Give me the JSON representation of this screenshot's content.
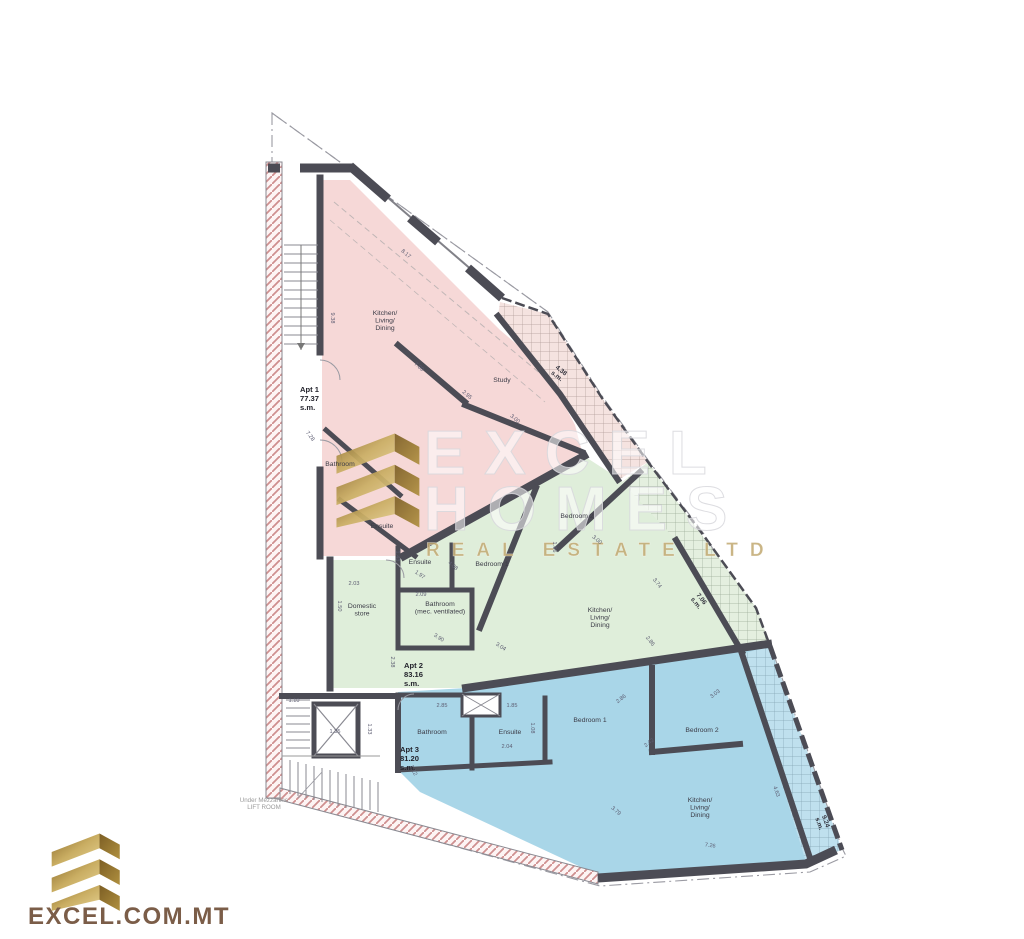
{
  "watermark": {
    "title": "EXCEL",
    "subtitle": "HOMES",
    "tagline": "REAL ESTATE LTD"
  },
  "brand": {
    "name": "EXCEL.COM.MT",
    "gold_dark": "#8a6a2a",
    "gold_light": "#e6d293",
    "text_color": "#7b5d48"
  },
  "plan": {
    "apartments": [
      {
        "name": "Apt 1",
        "area": "77.37",
        "unit": "s.m.",
        "color": "#f6d8d7"
      },
      {
        "name": "Apt 2",
        "area": "83.16",
        "unit": "s.m.",
        "color": "#dfeeda"
      },
      {
        "name": "Apt 3",
        "area": "81.20",
        "unit": "s.m.",
        "color": "#a9d6e8"
      }
    ],
    "apt_labels": [
      {
        "lines": [
          "Apt 1",
          "77.37",
          "s.m."
        ],
        "x": 300,
        "y": 392
      },
      {
        "lines": [
          "Apt 2",
          "83.16",
          "s.m."
        ],
        "x": 404,
        "y": 668
      },
      {
        "lines": [
          "Apt 3",
          "81.20",
          "s.m."
        ],
        "x": 400,
        "y": 752
      }
    ],
    "room_labels": [
      {
        "lines": [
          "Kitchen/",
          "Living/",
          "Dining"
        ],
        "x": 385,
        "y": 315
      },
      {
        "lines": [
          "Study"
        ],
        "x": 502,
        "y": 382
      },
      {
        "lines": [
          "Bathroom"
        ],
        "x": 340,
        "y": 466
      },
      {
        "lines": [
          "Ensuite"
        ],
        "x": 382,
        "y": 528
      },
      {
        "lines": [
          "Ensuite"
        ],
        "x": 420,
        "y": 564
      },
      {
        "lines": [
          "Bedroom 1"
        ],
        "x": 492,
        "y": 566
      },
      {
        "lines": [
          "Bedroom 2"
        ],
        "x": 577,
        "y": 518
      },
      {
        "lines": [
          "Domestic",
          "store"
        ],
        "x": 362,
        "y": 608
      },
      {
        "lines": [
          "Bathroom",
          "(mec. ventilated)"
        ],
        "x": 440,
        "y": 606
      },
      {
        "lines": [
          "Kitchen/",
          "Living/",
          "Dining"
        ],
        "x": 600,
        "y": 612
      },
      {
        "lines": [
          "Bathroom"
        ],
        "x": 432,
        "y": 734
      },
      {
        "lines": [
          "Ensuite"
        ],
        "x": 510,
        "y": 734
      },
      {
        "lines": [
          "Bedroom 1"
        ],
        "x": 590,
        "y": 722
      },
      {
        "lines": [
          "Bedroom 2"
        ],
        "x": 702,
        "y": 732
      },
      {
        "lines": [
          "Kitchen/",
          "Living/",
          "Dining"
        ],
        "x": 700,
        "y": 802
      }
    ],
    "terrace_labels": [
      {
        "lines": [
          "4.38",
          "s.m."
        ],
        "x": 560,
        "y": 372,
        "r": 38
      },
      {
        "lines": [
          "7.06",
          "s.m."
        ],
        "x": 700,
        "y": 600,
        "r": 52
      },
      {
        "lines": [
          "9.24",
          "s.m."
        ],
        "x": 824,
        "y": 822,
        "r": 70
      }
    ],
    "dimensions": [
      {
        "t": "8.17",
        "x": 405,
        "y": 255,
        "r": 40
      },
      {
        "t": "9.38",
        "x": 331,
        "y": 318,
        "r": 90
      },
      {
        "t": "7.89",
        "x": 418,
        "y": 368,
        "r": 40
      },
      {
        "t": "7.28",
        "x": 309,
        "y": 437,
        "r": 52
      },
      {
        "t": "2.95",
        "x": 466,
        "y": 396,
        "r": 40
      },
      {
        "t": "3.00",
        "x": 514,
        "y": 420,
        "r": 40
      },
      {
        "t": "1.43",
        "x": 396,
        "y": 556,
        "r": 90
      },
      {
        "t": "1.97",
        "x": 419,
        "y": 576,
        "r": 35
      },
      {
        "t": "4.08",
        "x": 452,
        "y": 567,
        "r": 40
      },
      {
        "t": "2.03",
        "x": 354,
        "y": 585,
        "r": 0
      },
      {
        "t": "2.09",
        "x": 421,
        "y": 596,
        "r": 0
      },
      {
        "t": "1.50",
        "x": 338,
        "y": 606,
        "r": 90
      },
      {
        "t": "3.90",
        "x": 438,
        "y": 639,
        "r": 33
      },
      {
        "t": "3.04",
        "x": 500,
        "y": 648,
        "r": 33
      },
      {
        "t": "2.38",
        "x": 391,
        "y": 662,
        "r": 90
      },
      {
        "t": "3.00",
        "x": 596,
        "y": 541,
        "r": 40
      },
      {
        "t": "1.66",
        "x": 553,
        "y": 547,
        "r": 90
      },
      {
        "t": "3.74",
        "x": 656,
        "y": 584,
        "r": 52
      },
      {
        "t": "2.86",
        "x": 649,
        "y": 642,
        "r": 52
      },
      {
        "t": "2.85",
        "x": 442,
        "y": 707,
        "r": 0
      },
      {
        "t": "1.85",
        "x": 512,
        "y": 707,
        "r": 0
      },
      {
        "t": "1.08",
        "x": 531,
        "y": 728,
        "r": 90
      },
      {
        "t": "2.04",
        "x": 507,
        "y": 748,
        "r": 0
      },
      {
        "t": "1.12",
        "x": 412,
        "y": 771,
        "r": 65
      },
      {
        "t": "2.86",
        "x": 622,
        "y": 700,
        "r": -38
      },
      {
        "t": "2.42",
        "x": 650,
        "y": 744,
        "r": -38
      },
      {
        "t": "3.03",
        "x": 716,
        "y": 695,
        "r": -38
      },
      {
        "t": "4.63",
        "x": 775,
        "y": 792,
        "r": 70
      },
      {
        "t": "3.79",
        "x": 615,
        "y": 812,
        "r": 40
      },
      {
        "t": "7.26",
        "x": 710,
        "y": 847,
        "r": 8
      },
      {
        "t": "1.35",
        "x": 335,
        "y": 733,
        "r": 0
      },
      {
        "t": "1.10",
        "x": 294,
        "y": 702,
        "r": 0
      },
      {
        "t": "1.33",
        "x": 368,
        "y": 729,
        "r": 90
      }
    ],
    "note": {
      "lines": [
        "Under Mezzanine",
        "LIFT ROOM"
      ],
      "x": 264,
      "y": 802
    }
  }
}
